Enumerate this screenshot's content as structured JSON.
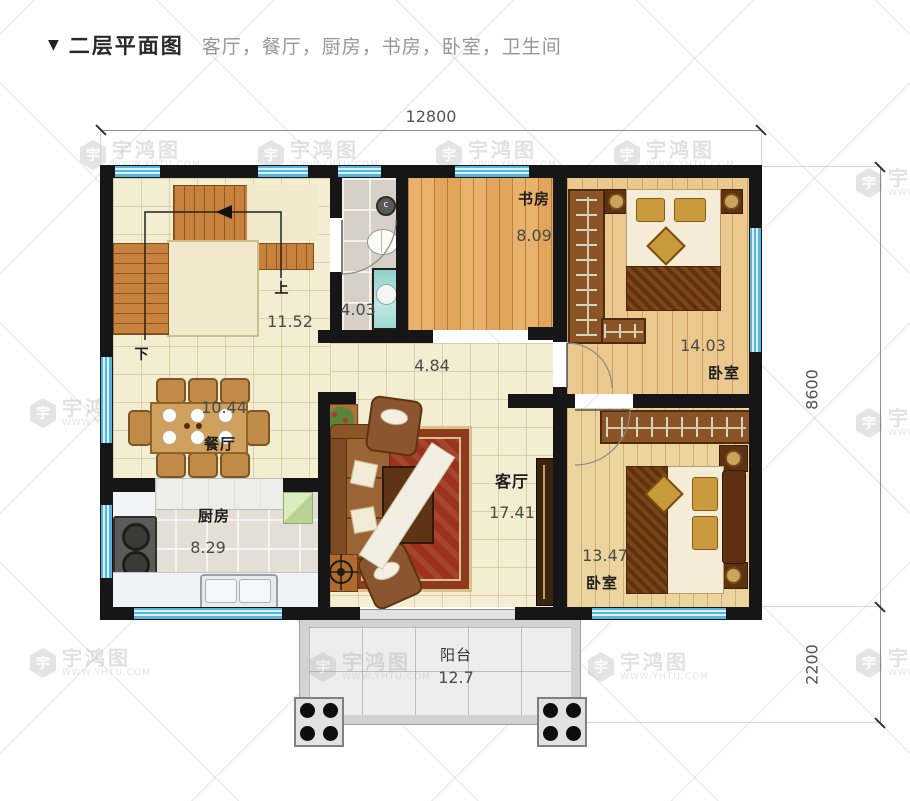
{
  "header": {
    "marker": "▼",
    "title": "二层平面图",
    "rooms_list": "客厅，餐厅，厨房，书房，卧室，卫生间"
  },
  "dimensions": {
    "width_top": "12800",
    "height_main": "8600",
    "height_balcony": "2200"
  },
  "rooms": {
    "study": {
      "name": "书房",
      "area": "8.09"
    },
    "bedroom_top": {
      "name": "卧室",
      "area": "14.03"
    },
    "bedroom_bottom": {
      "name": "卧室",
      "area": "13.47"
    },
    "living": {
      "name": "客厅",
      "area": "17.41"
    },
    "dining": {
      "name": "餐厅",
      "area": "10.44"
    },
    "kitchen": {
      "name": "厨房",
      "area": "8.29"
    },
    "bathroom": {
      "area": "4.03"
    },
    "hallway": {
      "area": "4.84"
    },
    "stairs": {
      "area": "11.52",
      "up_label": "上",
      "down_label": "下"
    },
    "balcony": {
      "name": "阳台",
      "area": "12.7"
    }
  },
  "watermark": {
    "brand": "宇鸿图",
    "site": "WWW.YHTU.COM",
    "logo_char": "宇"
  },
  "colors": {
    "wall": "#161616",
    "window_blue": "#57b4dd",
    "carpet_red": "#9c3120",
    "wood_study": "#e2a55c",
    "wood_bedroom": "#eac88e",
    "stair_orange": "#c9823d"
  }
}
